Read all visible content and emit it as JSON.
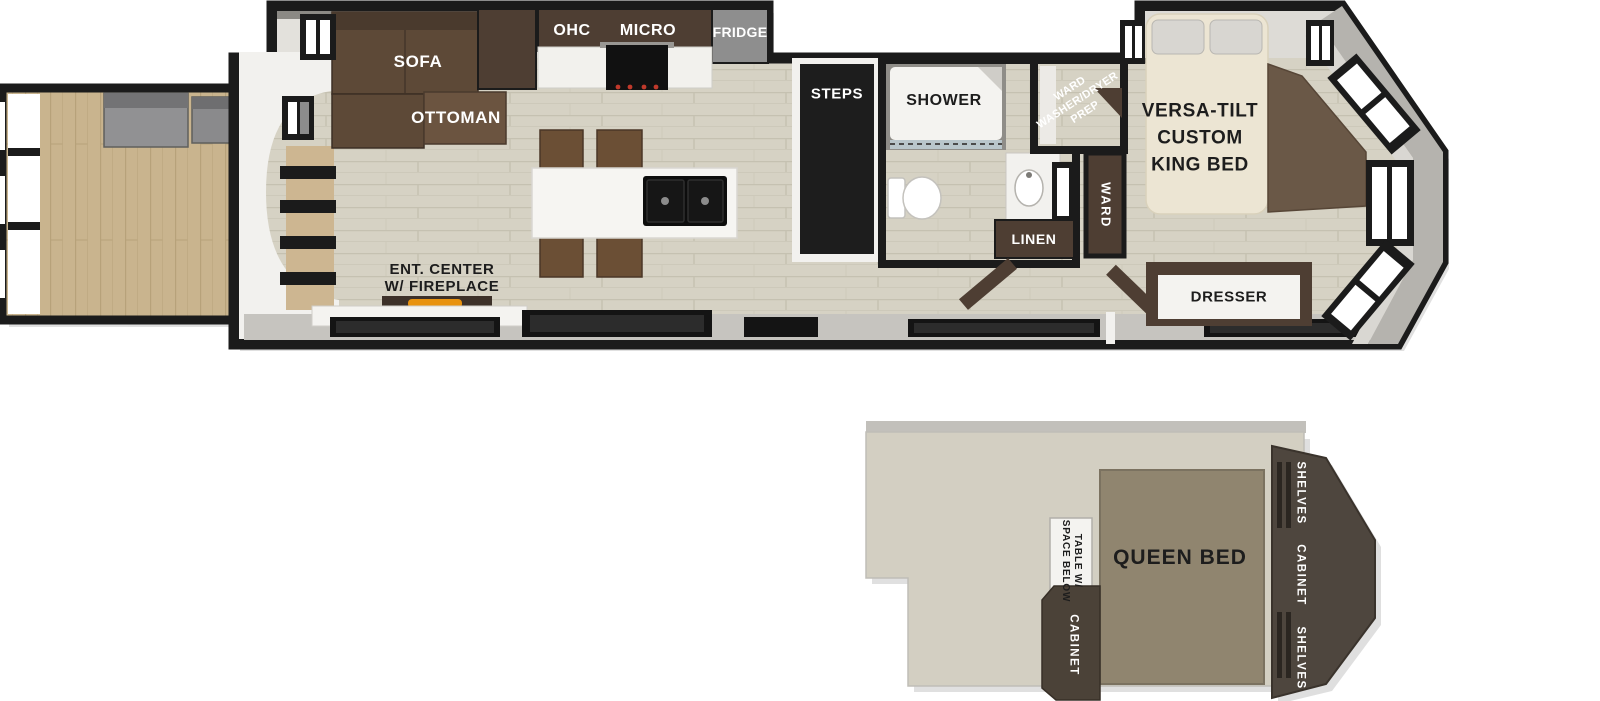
{
  "plan": {
    "main_floor": {
      "living": {
        "sofa": "SOFA",
        "ottoman": "OTTOMAN",
        "ent_center_line1": "ENT. CENTER",
        "ent_center_line2": "W/ FIREPLACE"
      },
      "kitchen": {
        "ohc": "OHC",
        "micro": "MICRO",
        "fridge": "FRIDGE"
      },
      "hall": {
        "steps": "STEPS"
      },
      "bath": {
        "shower": "SHOWER",
        "linen": "LINEN"
      },
      "utility": {
        "wd_prep_line1": "WARD",
        "wd_prep_line2": "WASHER/DRYER",
        "wd_prep_line3": "PREP",
        "ward": "WARD"
      },
      "bedroom": {
        "bed_line1": "VERSA-TILT",
        "bed_line2": "CUSTOM",
        "bed_line3": "KING BED",
        "dresser": "DRESSER"
      }
    },
    "loft": {
      "queen_bed": "QUEEN BED",
      "table_line1": "TABLE W/",
      "table_line2": "SPACE BELOW",
      "cabinet": "CABINET",
      "shelves_top": "SHELVES",
      "cabinet_right": "CABINET",
      "shelves_bottom": "SHELVES"
    }
  },
  "colors": {
    "wall_black": "#1b1b1b",
    "interior_floor": "#d6d2c4",
    "deck_wood": "#c9b48e",
    "cabinet_brown": "#4e3e33",
    "sofa_brown": "#5d4937",
    "gray_wall": "#b5b3ae",
    "fridge_gray": "#8e8e8e",
    "king_bed_cream": "#ece5d3",
    "queen_bed_taupe": "#90856f",
    "loft_floor": "#d3cfc2",
    "flame_orange": "#e8920f"
  }
}
